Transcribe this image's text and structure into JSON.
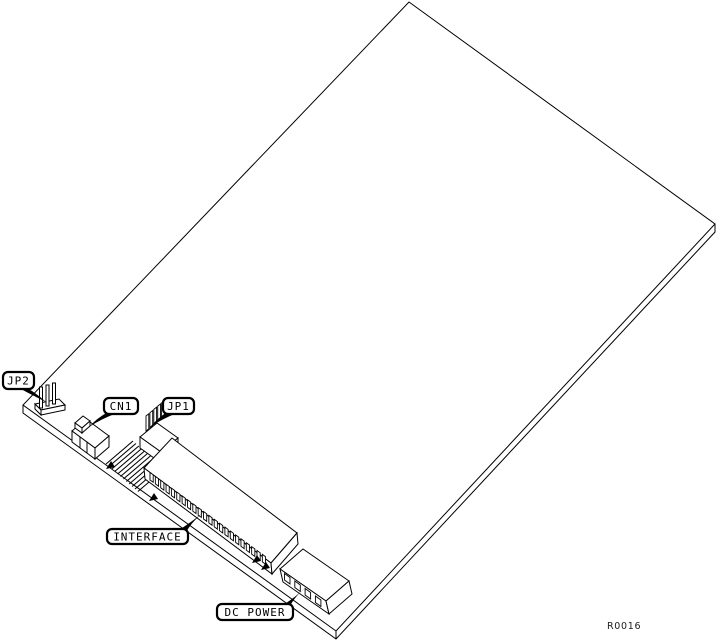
{
  "figure": {
    "background_color": "#ffffff",
    "line_color": "#000000",
    "ref_code": "R0016",
    "callouts": [
      {
        "label": "JP2",
        "target": "jp2-pin-header"
      },
      {
        "label": "CN1",
        "target": "cn1-connector"
      },
      {
        "label": "JP1",
        "target": "jp1-pin-header"
      },
      {
        "label": "INTERFACE",
        "target": "interface-connector"
      },
      {
        "label": "DC POWER",
        "target": "dc-power-connector"
      }
    ]
  }
}
